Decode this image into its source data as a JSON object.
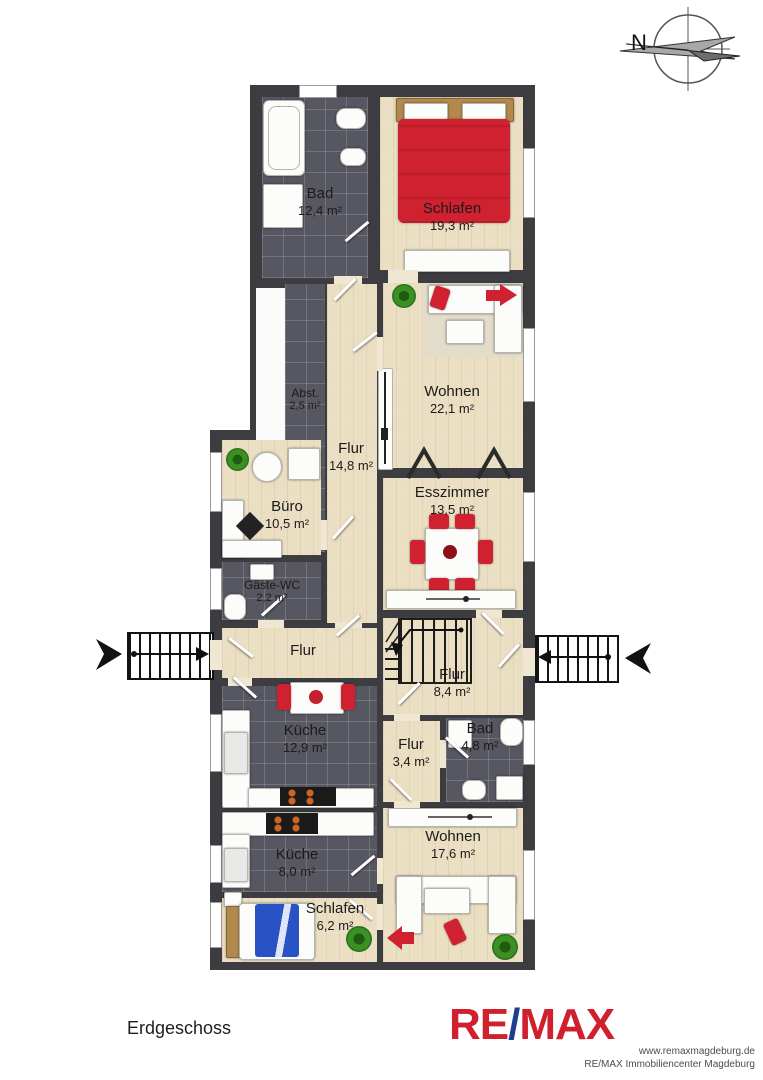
{
  "floor": {
    "label": "Erdgeschoss"
  },
  "compass": {
    "north_label": "N"
  },
  "branding": {
    "logo_re": "RE",
    "logo_slash": "/",
    "logo_max": "MAX",
    "website": "www.remaxmagdeburg.de",
    "company": "RE/MAX Immobiliencenter Magdeburg",
    "logo_red": "#d0202e",
    "logo_blue": "#1d3e8f"
  },
  "rooms": [
    {
      "name": "Bad",
      "area": "12,4 m²"
    },
    {
      "name": "Schlafen",
      "area": "19,3 m²"
    },
    {
      "name": "Abst.",
      "area": "2,5 m²"
    },
    {
      "name": "Wohnen",
      "area": "22,1 m²"
    },
    {
      "name": "Flur",
      "area": "14,8 m²"
    },
    {
      "name": "Esszimmer",
      "area": "13,5 m²"
    },
    {
      "name": "Büro",
      "area": "10,5 m²"
    },
    {
      "name": "Gäste-WC",
      "area": "2,2 m²"
    },
    {
      "name": "Flur",
      "area": ""
    },
    {
      "name": "Flur",
      "area": "8,4 m²"
    },
    {
      "name": "Küche",
      "area": "12,9 m²"
    },
    {
      "name": "Flur",
      "area": "3,4 m²"
    },
    {
      "name": "Bad",
      "area": "4,8 m²"
    },
    {
      "name": "Wohnen",
      "area": "17,6 m²"
    },
    {
      "name": "Küche",
      "area": "8,0 m²"
    },
    {
      "name": "Schlafen",
      "area": "6,2 m²"
    }
  ],
  "colors": {
    "wall": "#3c3c41",
    "wood_floor": "#ebdfc3",
    "tile_floor": "#575762",
    "accent_red": "#cf2130",
    "bed_blue": "#2953c4",
    "plant_green": "#3c8f24"
  }
}
